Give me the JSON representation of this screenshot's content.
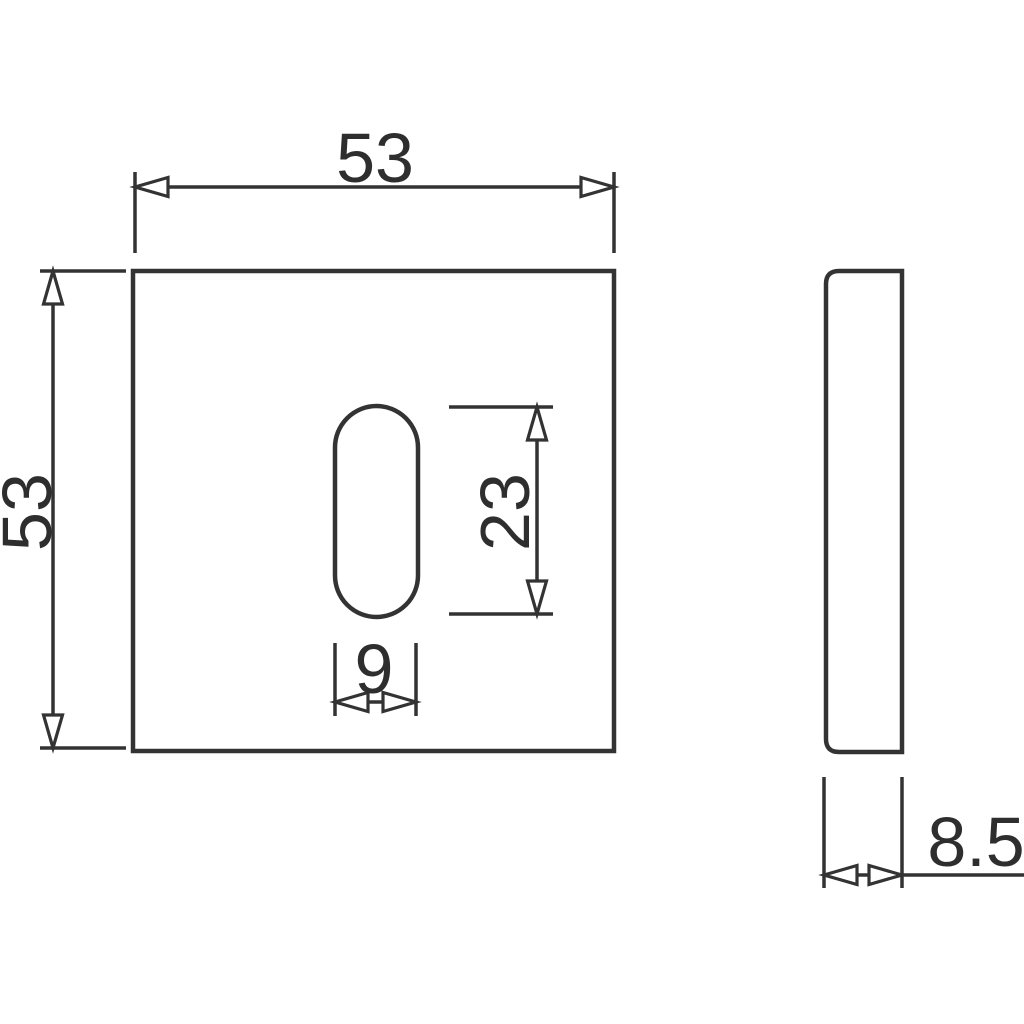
{
  "drawing": {
    "type": "technical-dimension-drawing",
    "line_color": "#333333",
    "text_color": "#2e2e2e",
    "background_color": "#ffffff",
    "front_view": {
      "plate_width": "53",
      "plate_height": "53",
      "slot_height": "23",
      "slot_width": "9"
    },
    "side_view": {
      "thickness": "8.5"
    }
  }
}
